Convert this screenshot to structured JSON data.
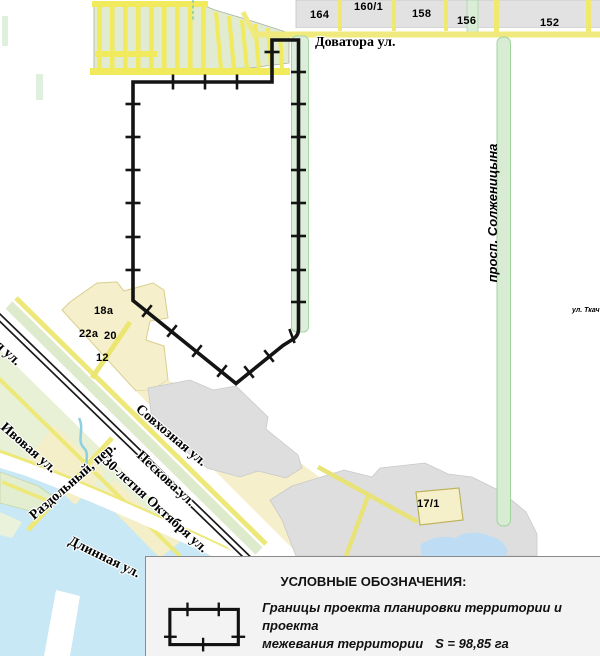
{
  "map": {
    "streets": {
      "dovatora": "Доватора ул.",
      "solzhenitsyn": "просп. Солженицына",
      "tkacheva": "ул. Ткач",
      "sovkhoznaya": "Совхозная ул.",
      "peskova": "Пескова ул.",
      "oktyabrya": "30-летия Октября ул.",
      "razdolny": "Раздольный, пер.",
      "ivovaya": "Ивовая ул.",
      "dlinnaya": "Длинная ул.",
      "edge_street": "я ул."
    },
    "parcels": {
      "p164": "164",
      "p160_1": "160/1",
      "p158": "158",
      "p156": "156",
      "p152": "152",
      "p18a": "18а",
      "p22a": "22а",
      "p20": "20",
      "p12": "12",
      "p17_1": "17/1"
    },
    "colors": {
      "boundary": "#141414",
      "road_yellow": "#EFE96F",
      "parcel_cream": "#F5EFCB",
      "parcel_green": "#E0EBD1",
      "strip_green": "#D7ECD3",
      "block_gray": "#DEDEDE",
      "water_blue": "#C7E8F4",
      "legend_bg": "#F3F3F3"
    }
  },
  "legend": {
    "title": "УСЛОВНЫЕ ОБОЗНАЧЕНИЯ:",
    "item_line1": "Границы проекта планировки территории и проекта",
    "item_line2": "межевания территории",
    "area_value": "S = 98,85 га"
  }
}
